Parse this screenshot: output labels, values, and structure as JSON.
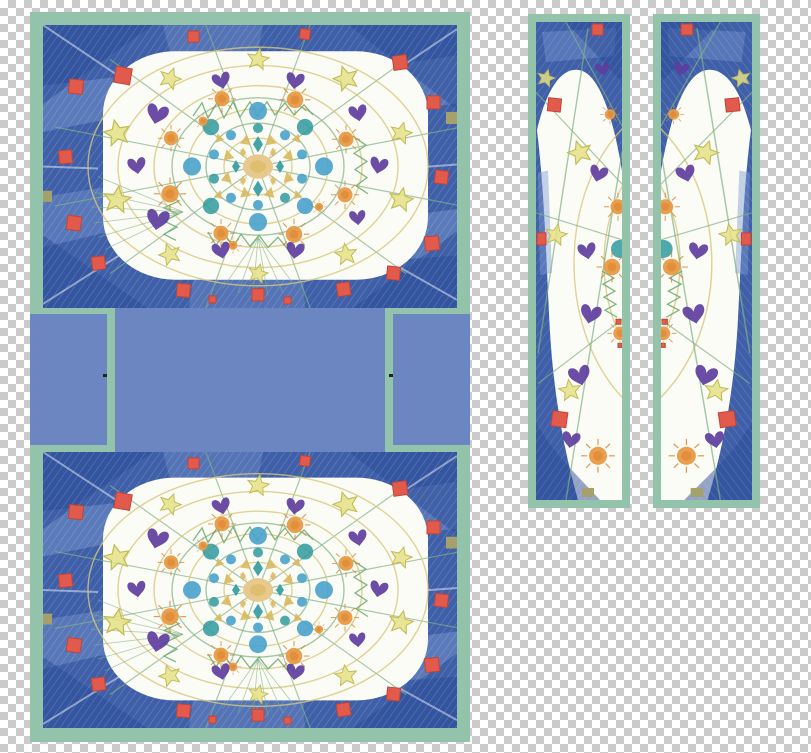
{
  "image": {
    "description": "Child's crayon-and-pencil mandala drawing scanned and arranged as cut-apart printable pattern pieces on a transparent checkerboard background",
    "pieces": [
      "top panel",
      "connector band with left tab, center gusset and right tab",
      "bottom panel",
      "left side strip",
      "right side strip"
    ],
    "motifs": [
      "purple-heart",
      "yellow-star",
      "orange-sun",
      "blue-circle",
      "teal-circle",
      "gold-triangle",
      "teal-diamond",
      "gold-diamond",
      "red-square",
      "khaki-square",
      "center-sun",
      "green-radial-lines",
      "concentric-rings",
      "green-zigzag-scribble",
      "blue-crayon-frame",
      "sage-green-edging"
    ]
  },
  "colors": {
    "checker_light": "#ffffff",
    "checker_dark": "#cbcbcb",
    "border_green": "#94c3ab",
    "periwinkle": "#6b86c0",
    "crayon_blue": "#3f60a8",
    "crayon_blue_light": "#7d9cd1",
    "crayon_blue_dark": "#2a4a96",
    "paper": "#fcfcf7",
    "red_square": "#e25a4c",
    "red_square_dark": "#c34437",
    "khaki_square": "#a6a06a",
    "orange_sun": "#e89a43",
    "orange_sun_dark": "#d97f2c",
    "yellow_star": "#e5e086",
    "star_stroke": "#c2bb55",
    "purple_heart": "#5e3e9e",
    "blue_circle": "#49a2cc",
    "teal_shape": "#2f9aa0",
    "gold_shape": "#d9b85c",
    "center_tan": "#e7c98d",
    "ring_yellow": "#d8c77c",
    "line_green": "#82b184",
    "zigzag_green": "#6aa96c",
    "crop_mark": "#222222"
  }
}
